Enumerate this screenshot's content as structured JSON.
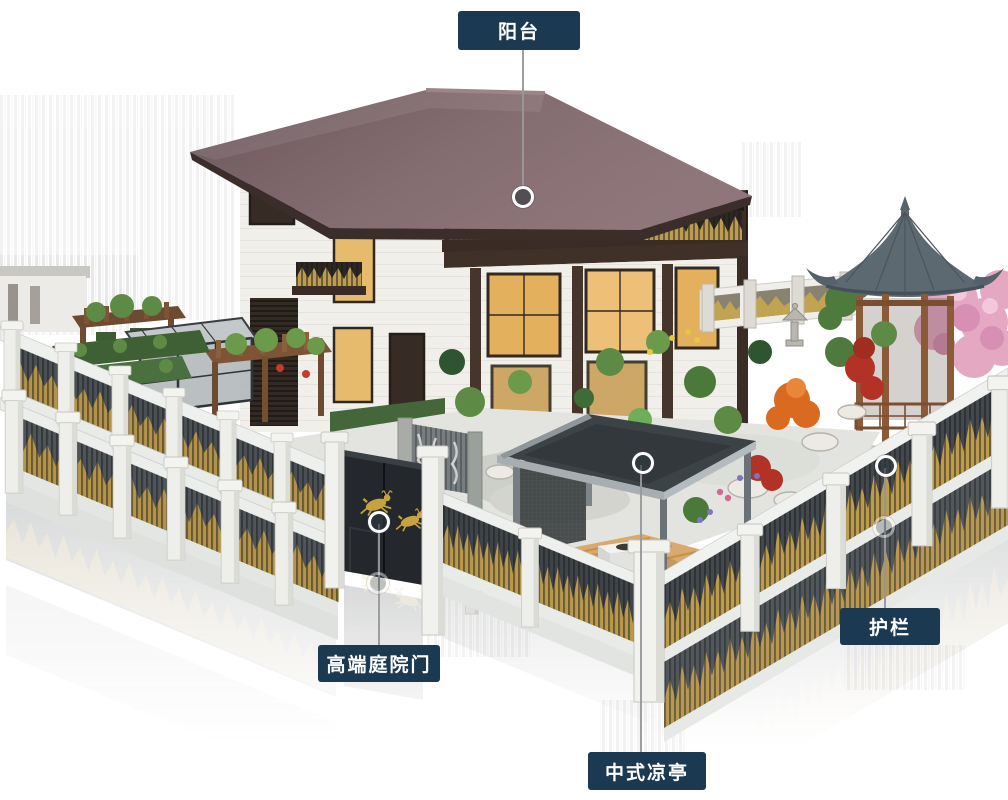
{
  "annotation": {
    "style": {
      "label_background": "#1b3a52",
      "label_text_color": "#ffffff",
      "leader_line_color": "#97999b",
      "marker_ring_color": "#ffffff",
      "marker_fill_color": "#2f3a40"
    },
    "callouts": [
      {
        "id": "balcony",
        "label": "阳台"
      },
      {
        "id": "premium-courtyard-gate",
        "label": "高端庭院门"
      },
      {
        "id": "chinese-pavilion",
        "label": "中式凉亭"
      },
      {
        "id": "guardrail",
        "label": "护栏"
      }
    ]
  },
  "scene": {
    "palette": {
      "roof": "#7b666a",
      "roof_fascia": "#3b2e2a",
      "wall_white": "#f1efe9",
      "wood_dark": "#3d2f27",
      "railing_gold": "#bd9c4f",
      "fence_white": "#f3f3f1",
      "fence_panel_dark": "#4b5054",
      "gate_door": "#24282c",
      "gate_deer_gold": "#c8a23f",
      "pavilion_roof": "#3c4347",
      "deck_wood": "#d9a96d",
      "gazebo_roof": "#5d6971",
      "gazebo_wood": "#8a5a39",
      "blossom_pink": "#e4a8c3",
      "maple_orange": "#d96a1f",
      "maple_red": "#b23226",
      "foliage_green": "#5d8a44",
      "paving_gray": "#d9dbd5",
      "window_glow": "#e6b362"
    }
  }
}
